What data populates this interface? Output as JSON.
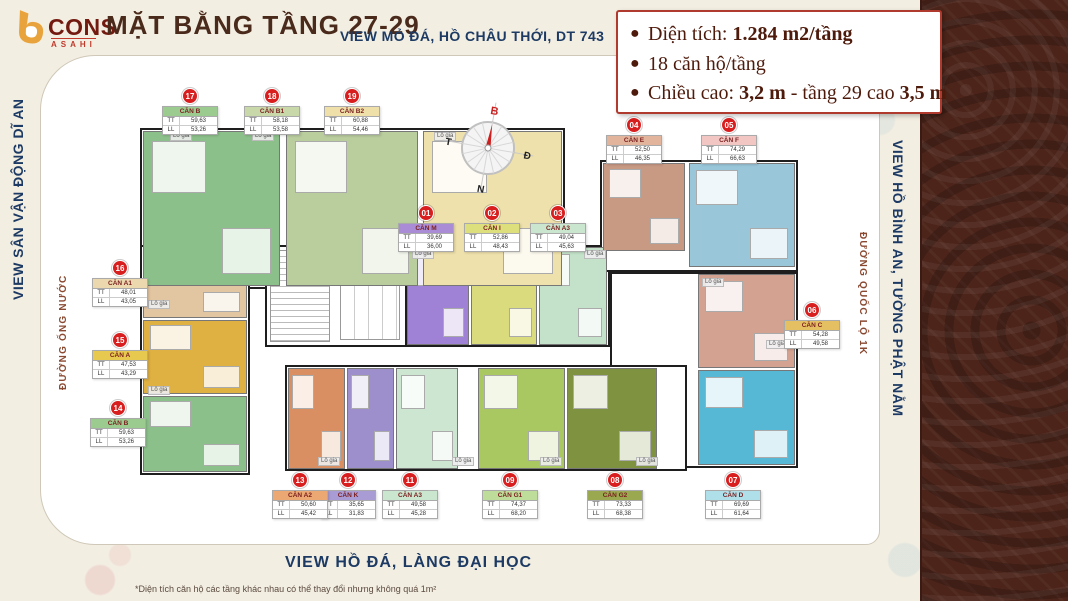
{
  "brand": {
    "cons": "CONS",
    "asahi": "ASAHI"
  },
  "header": {
    "title": "MẶT BẰNG TẦNG 27-29",
    "subtitle": "VIEW MỎ ĐÁ, HỒ CHÂU THỚI, DT 743"
  },
  "info_box": {
    "line1_label": "Diện tích: ",
    "line1_value": "1.284 m2/tầng",
    "line2": "18 căn hộ/tầng",
    "line3_label": "Chiều cao: ",
    "line3_bold1": "3,2 m",
    "line3_mid": " - tầng 29 cao ",
    "line3_bold2": "3,5 m"
  },
  "edges": {
    "left_view": "VIEW SÂN VẬN ĐỘNG DĨ AN",
    "left_road": "ĐƯỜNG ỐNG NƯỚC",
    "right_view": "VIEW HỒ BÌNH AN, TƯỜNG PHẬT NẰM",
    "right_road": "ĐƯỜNG QUỐC LỘ 1K",
    "bottom_view": "VIEW HỒ ĐÁ, LÀNG ĐẠI HỌC",
    "footnote": "*Diện tích căn hộ các tầng khác nhau có thể thay đổi nhưng không quá 1m²"
  },
  "compass": {
    "north": "B",
    "east": "Đ",
    "west": "T",
    "south": "N",
    "needle_color": "#cc1f1f"
  },
  "plan": {
    "lo_gia": "Lô gia",
    "row_tt": "TT",
    "row_ll": "LL"
  },
  "colors": {
    "badge_red": "#d81e1e",
    "navy": "#1c3a63",
    "maroon": "#4d1a0b",
    "strip_brown": "#4c241a",
    "bg_cream": "#f3eee2"
  },
  "units": [
    {
      "no": "01",
      "name": "CĂN M",
      "tt": "39,69",
      "ll": "36,00",
      "header_color": "#a98bd6",
      "fill": "#9f82d5"
    },
    {
      "no": "02",
      "name": "CĂN I",
      "tt": "52,86",
      "ll": "48,43",
      "header_color": "#ddde7c",
      "fill": "#d9db7c"
    },
    {
      "no": "03",
      "name": "CĂN A3",
      "tt": "49,04",
      "ll": "45,63",
      "header_color": "#cbe6cf",
      "fill": "#c3e2c9"
    },
    {
      "no": "04",
      "name": "CĂN E",
      "tt": "52,50",
      "ll": "46,35",
      "header_color": "#e2b49b",
      "fill": "#c89a84"
    },
    {
      "no": "05",
      "name": "CĂN F",
      "tt": "74,29",
      "ll": "66,63",
      "header_color": "#f2c7c3",
      "fill": "#9ac6da"
    },
    {
      "no": "06",
      "name": "CĂN C",
      "tt": "54,28",
      "ll": "49,58",
      "header_color": "#e5c063",
      "fill": "#d4a291"
    },
    {
      "no": "07",
      "name": "CĂN D",
      "tt": "69,69",
      "ll": "61,64",
      "header_color": "#afe0ea",
      "fill": "#56b8d4"
    },
    {
      "no": "08",
      "name": "CĂN G2",
      "tt": "73,33",
      "ll": "68,38",
      "header_color": "#9aa94f",
      "fill": "#7e923f"
    },
    {
      "no": "09",
      "name": "CĂN G1",
      "tt": "74,37",
      "ll": "68,20",
      "header_color": "#bfdd9a",
      "fill": "#a9c862"
    },
    {
      "no": "11",
      "name": "CĂN A3",
      "tt": "49,58",
      "ll": "45,28",
      "header_color": "#cbe6cf",
      "fill": "#cde6d2"
    },
    {
      "no": "12",
      "name": "CĂN K",
      "tt": "35,65",
      "ll": "31,83",
      "header_color": "#a99bd4",
      "fill": "#9d8fcb"
    },
    {
      "no": "13",
      "name": "CĂN A2",
      "tt": "50,60",
      "ll": "45,42",
      "header_color": "#eba873",
      "fill": "#d98f62"
    },
    {
      "no": "14",
      "name": "CĂN B",
      "tt": "59,63",
      "ll": "53,26",
      "header_color": "#9ccb8f",
      "fill": "#8cc08b"
    },
    {
      "no": "15",
      "name": "CĂN A",
      "tt": "47,53",
      "ll": "43,29",
      "header_color": "#e7c94f",
      "fill": "#dfb042"
    },
    {
      "no": "16",
      "name": "CĂN A1",
      "tt": "48,01",
      "ll": "43,05",
      "header_color": "#ebd8ae",
      "fill": "#e2c5a1"
    },
    {
      "no": "17",
      "name": "CĂN B",
      "tt": "59,63",
      "ll": "53,26",
      "header_color": "#9ccb8f",
      "fill": "#8cc08b"
    },
    {
      "no": "18",
      "name": "CĂN B1",
      "tt": "58,18",
      "ll": "53,58",
      "header_color": "#c9d8a8",
      "fill": "#b9cd9d"
    },
    {
      "no": "19",
      "name": "CĂN B2",
      "tt": "60,88",
      "ll": "54,46",
      "header_color": "#efdfa8",
      "fill": "#efe1ab"
    }
  ]
}
